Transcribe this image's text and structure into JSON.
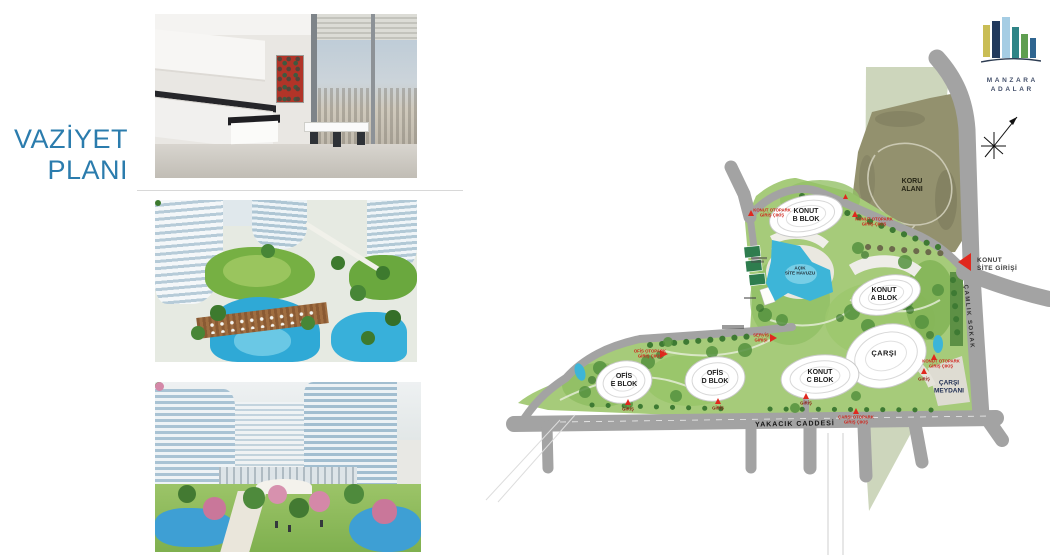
{
  "slide": {
    "title": "VAZİYET\nPLANI"
  },
  "brand": {
    "logo_line1": "MANZARA",
    "logo_line2": "ADALAR",
    "bar_colors": [
      "#c9bd55",
      "#223a5e",
      "#a5cde4",
      "#2f8486",
      "#5f9e50",
      "#2f6590"
    ]
  },
  "photos": [
    {
      "id": "kitchen-interior",
      "alt": "modern white kitchen with city-view window and red artwork"
    },
    {
      "id": "aerial-courtyard-render",
      "alt": "aerial render of curved towers, green roofs, decks and pools"
    },
    {
      "id": "courtyard-promenade-render",
      "alt": "courtyard render with ponds, blossom trees and residential towers"
    }
  ],
  "site_plan": {
    "labels": [
      {
        "id": "koru-alani",
        "text": "KORU\nALANI"
      },
      {
        "id": "konut-b-blok",
        "text": "KONUT\nB BLOK"
      },
      {
        "id": "konut-a-blok",
        "text": "KONUT\nA BLOK"
      },
      {
        "id": "konut-c-blok",
        "text": "KONUT\nC BLOK"
      },
      {
        "id": "ofis-d-blok",
        "text": "OFİS\nD BLOK"
      },
      {
        "id": "ofis-e-blok",
        "text": "OFİS\nE BLOK"
      },
      {
        "id": "carsi",
        "text": "ÇARŞI"
      },
      {
        "id": "acik-site-havuzu",
        "text": "AÇIK\nSİTE HAVUZU"
      },
      {
        "id": "carsi-meydani",
        "text": "ÇARŞI\nMEYDANI"
      },
      {
        "id": "konut-site-girisi",
        "text": "KONUT\nSİTE GİRİŞİ"
      },
      {
        "id": "yakacik-caddesi",
        "text": "YAKACIK CADDESİ"
      },
      {
        "id": "camlik-sokak",
        "text": "ÇAMLIK SOKAK"
      },
      {
        "id": "konut-otopark-giris-bati",
        "text": "KONUT OTOPARK\nGİRİŞ ÇIKIŞ"
      },
      {
        "id": "konut-otopark-giris-kuzey",
        "text": "KONUT OTOPARK\nGİRİŞ-ÇIKIŞ"
      },
      {
        "id": "ofis-otopark-giris",
        "text": "OFİS OTOPARK\nGİRİŞ ÇIKIŞ"
      },
      {
        "id": "servis-girisi",
        "text": "SERVİS\nGİRİŞİ"
      },
      {
        "id": "konut-otopark-giris-dogu",
        "text": "KONUT OTOPARK\nGİRİŞ ÇIKIŞ"
      },
      {
        "id": "carsi-otopark-giris",
        "text": "ÇARŞI OTOPARK\nGİRİŞ ÇIKIŞ"
      },
      {
        "id": "giris-ofis-e",
        "text": "GİRİŞ"
      },
      {
        "id": "giris-ofis-d",
        "text": "GİRİŞ"
      },
      {
        "id": "giris-konut-c",
        "text": "GİRİŞ"
      },
      {
        "id": "giris-carsi",
        "text": "GİRİŞ"
      }
    ],
    "colors": {
      "title_blue": "#2b7cad",
      "road_gray": "#a3a3a3",
      "koru_olive": "#93916e",
      "highlight_band": "#bcc8a6",
      "landscape_green": "#a6cb7a",
      "pool_teal": "#3db5d8",
      "marker_red": "#e0281e"
    }
  }
}
